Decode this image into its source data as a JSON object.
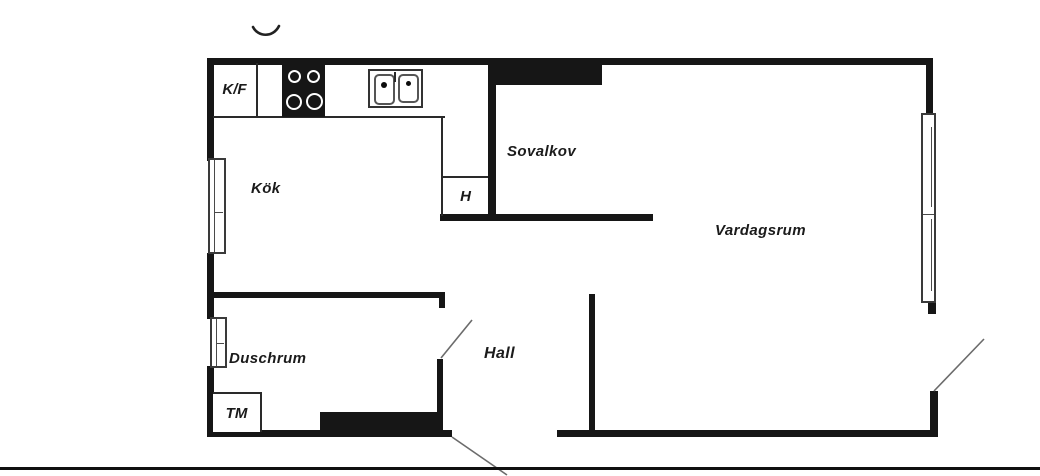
{
  "floorplan": {
    "labels": {
      "fridge_freezer": "K/F",
      "kitchen": "Kök",
      "sleeping_alcove": "Sovalkov",
      "closet": "H",
      "living_room": "Vardagsrum",
      "shower_room": "Duschrum",
      "washing_machine": "TM",
      "hall": "Hall"
    },
    "colors": {
      "wall": "#161616",
      "background": "#ffffff",
      "label_text": "#1b1b1b",
      "door_swing": "#6b6b6b"
    }
  }
}
